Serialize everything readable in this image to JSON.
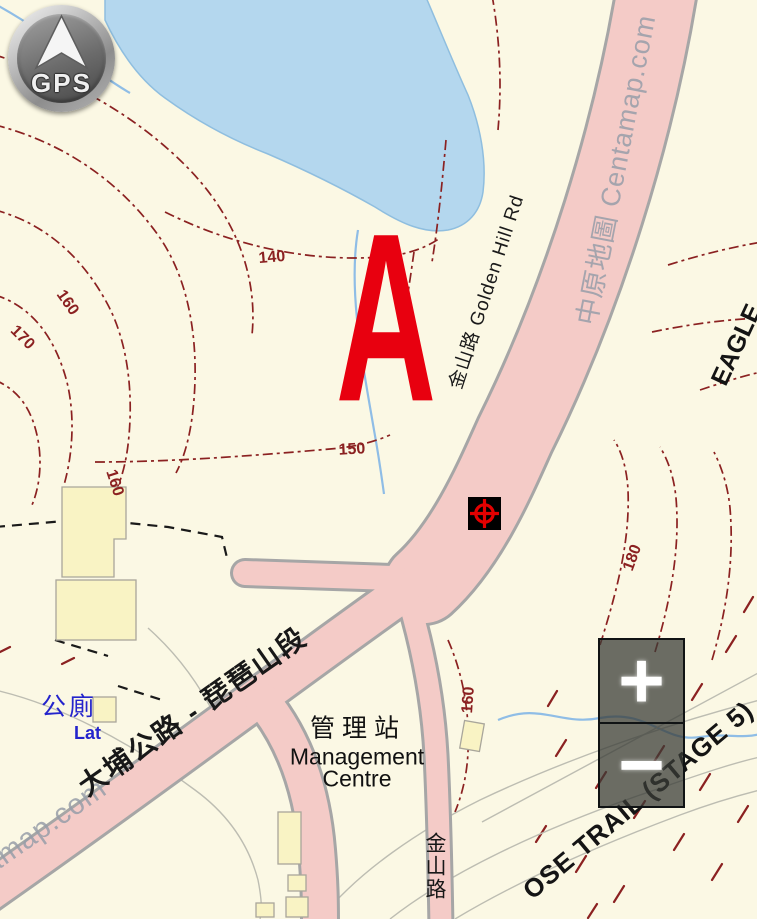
{
  "controls": {
    "gps_label": "GPS",
    "zoom_in_glyph": "+",
    "zoom_out_glyph": "−"
  },
  "marker": {
    "label": "A"
  },
  "map_labels": {
    "golden_hill_road": "金山路  Golden Hill Rd",
    "tai_po_road": "大埔公路 - 琵琶山段",
    "south_road": "金山路",
    "toilet_zh": "公廁",
    "toilet_en": "Lat",
    "management_zh": "管理站",
    "management_en_line1": "Management",
    "management_en_line2": "Centre",
    "trail_eagle": "EAGLE",
    "trail_stage5": "OSE TRAIL (STAGE 5)",
    "watermark_top": "中原地圖 Centamap.com",
    "watermark_bottom": "amap.com"
  },
  "contour_labels": [
    {
      "text": "140"
    },
    {
      "text": "150"
    },
    {
      "text": "160"
    },
    {
      "text": "170"
    },
    {
      "text": "160"
    },
    {
      "text": "180"
    },
    {
      "text": "160"
    }
  ],
  "colors": {
    "marker_red": "#e8000f",
    "contour_maroon": "#8b2121",
    "road_pink": "#f4cbc7",
    "road_casing": "#a6a6a6",
    "water_blue": "#b4d7ee",
    "building_yellow": "#f9f3c4",
    "poi_blue": "#2424cc",
    "watermark_gray": "#969ea8"
  }
}
